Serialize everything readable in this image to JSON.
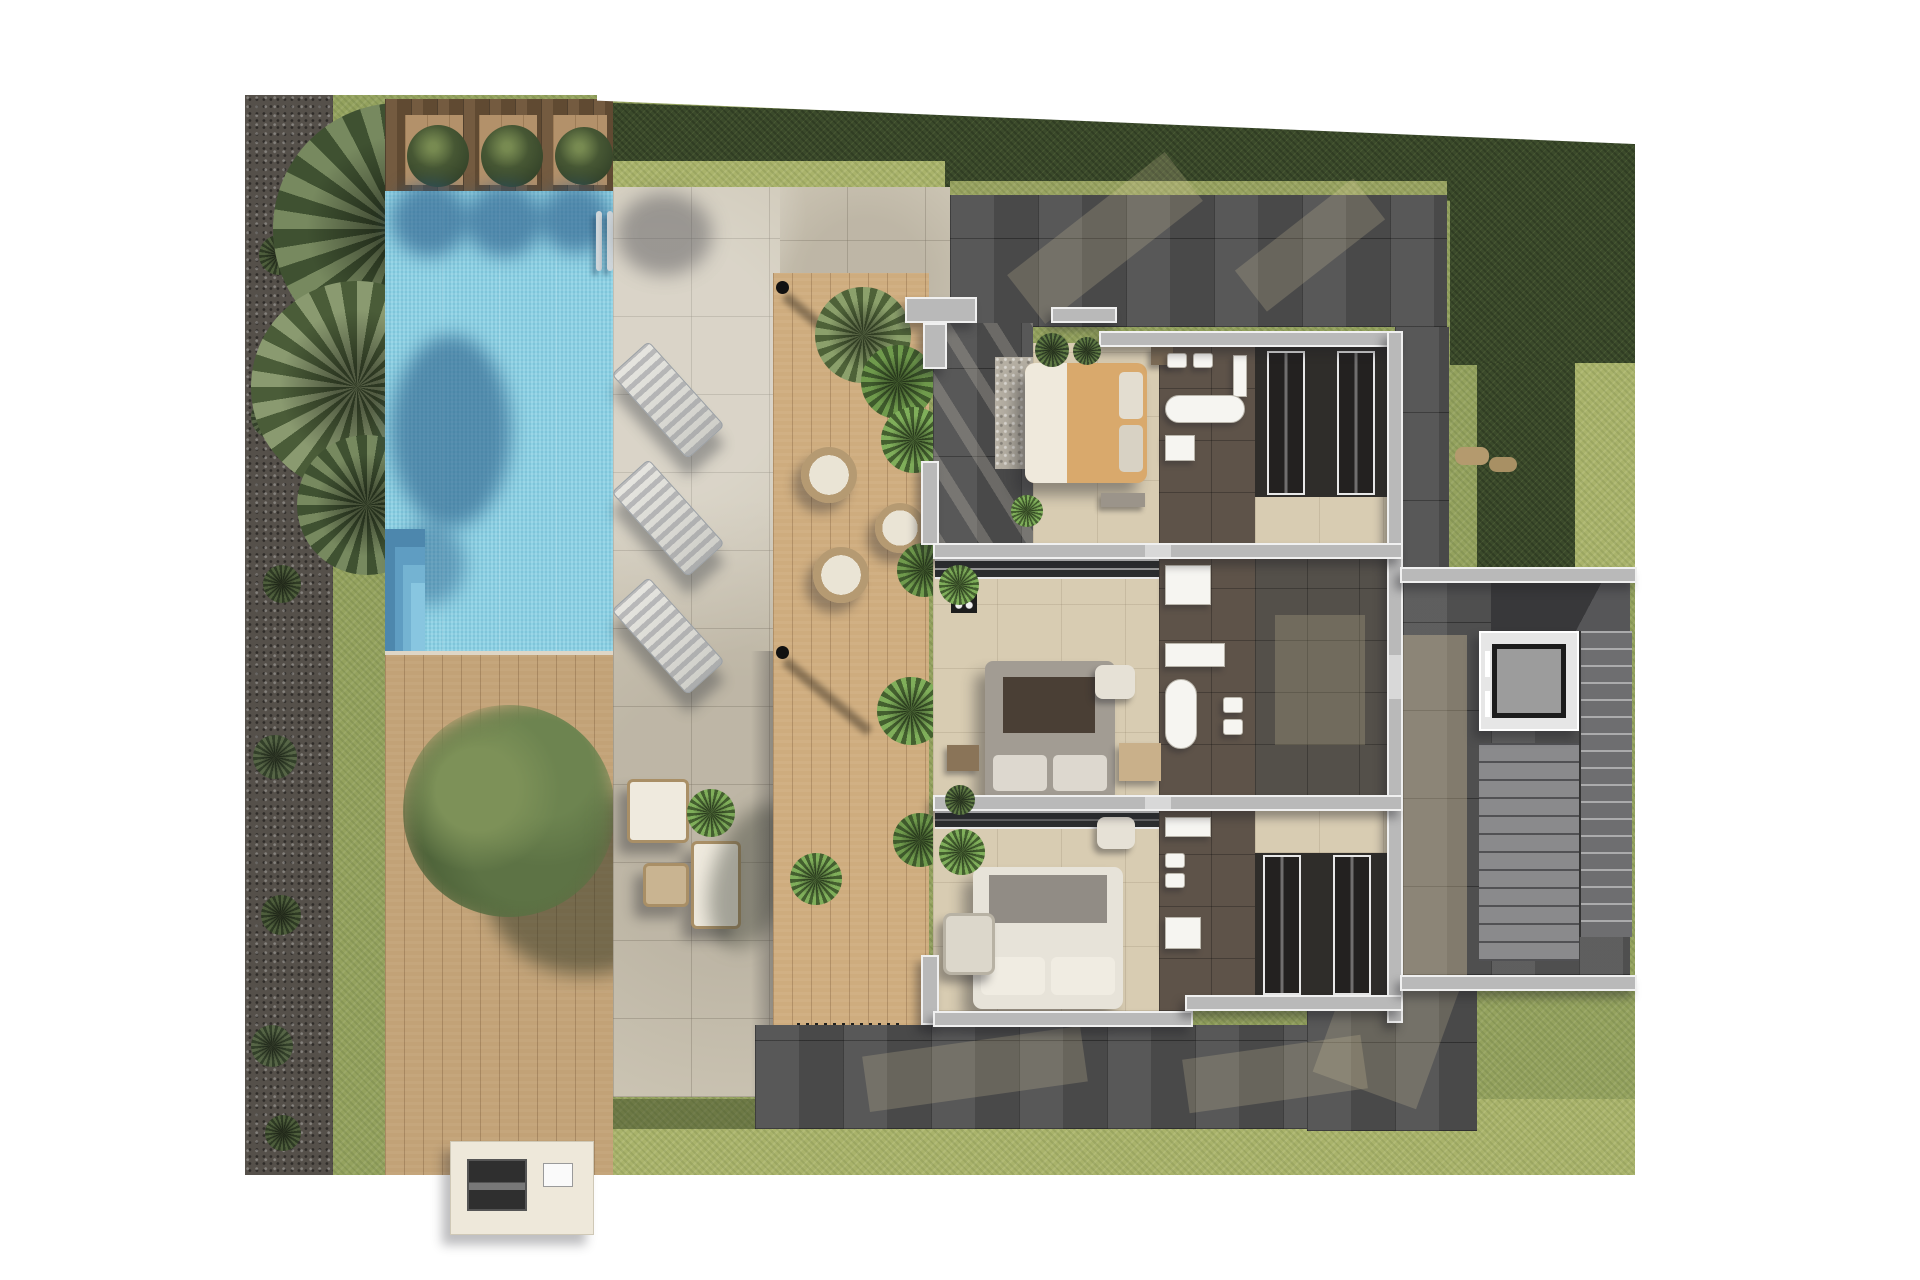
{
  "scene": {
    "type": "architectural-render",
    "view": "top-down-first-floor-plan",
    "background": "#ffffff"
  },
  "palette": {
    "grass": "#94a25e",
    "grassBright": "#a9b36b",
    "hedge": "#3b4a2b",
    "hedgeLight": "#aab572",
    "gravel": "#55504a",
    "woodDark": "#6b5238",
    "woodLight": "#b3916a",
    "deck": "#c2a277",
    "stone": "#cdc6b5",
    "paverDark": "#4f4f4f",
    "water": "#8fd3e5",
    "waterShadow": "#3c77a4",
    "poolStep1": "#4d87ad",
    "poolStep2": "#5f9dc2",
    "poolStep3": "#74b3d2",
    "poolStep4": "#88c6e0",
    "wall": "#b9b9b9",
    "wallEdge": "#f0f0f0",
    "floorBeige": "#d8ccb2",
    "bathFloor": "#5e5349",
    "wardrobeDark": "#2f2d2a",
    "bedTan": "#d9a96c",
    "bedGray": "#a29c93",
    "bedWhite": "#e7e3d9",
    "elevatorCar": "#9c9c9c",
    "rattan": "#a98f66",
    "sunPatch": "#e8d7ac"
  },
  "areas": {
    "garden": [
      "gravel-border",
      "lawn",
      "palm-trees",
      "perimeter-hedge",
      "shrubs"
    ],
    "pool_zone": [
      "swimming-pool",
      "corner-steps",
      "pool-ladder",
      "timber-head-deck",
      "boxwood-balls",
      "sun-loungers"
    ],
    "terrace": [
      "stone-patio",
      "timber-walkway",
      "rattan-chairs",
      "outdoor-lounge-set",
      "outdoor-kitchen-bbq",
      "shade-tree",
      "potted-plants",
      "shade-sail-posts"
    ],
    "house": {
      "bedrooms": [
        "bedroom-1-tan-bed",
        "bedroom-2-gray-bed",
        "bedroom-3-white-bed"
      ],
      "bathrooms": [
        "bathroom-1",
        "bathroom-2",
        "bathroom-3"
      ],
      "other": [
        "private-terrace",
        "wardrobe-room",
        "walk-in-closets",
        "hallway",
        "staircase",
        "elevator",
        "ac-unit",
        "window-bands"
      ]
    }
  }
}
